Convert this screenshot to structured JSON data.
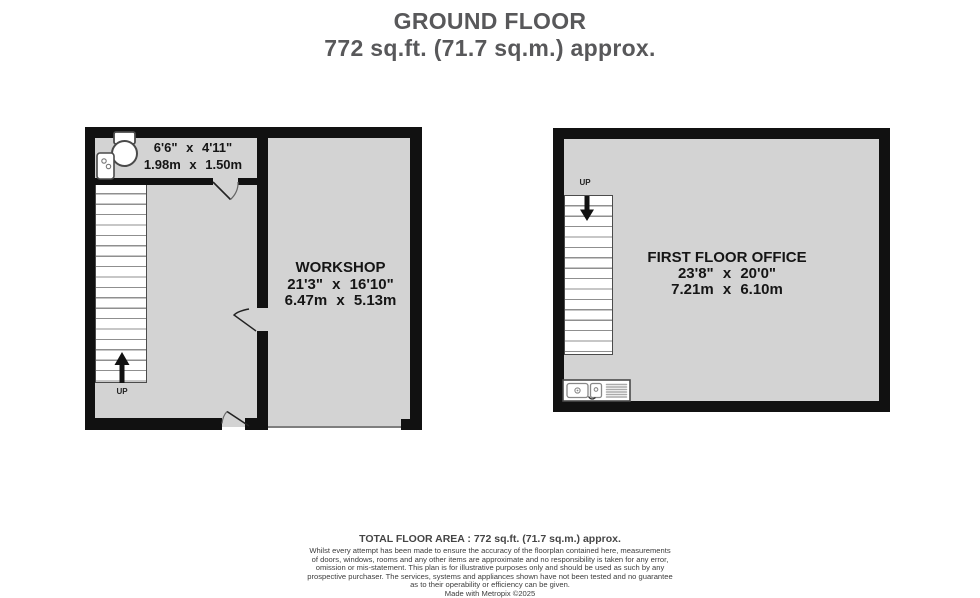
{
  "title": {
    "floor": "GROUND FLOOR",
    "area": "772 sq.ft. (71.7 sq.m.) approx."
  },
  "ground_floor_plan": {
    "wc": {
      "dims_imperial": "6'6\" x 4'11\"",
      "dims_metric": "1.98m x 1.50m"
    },
    "workshop": {
      "name": "WORKSHOP",
      "dims_imperial": "21'3\" x 16'10\"",
      "dims_metric": "6.47m x 5.13m"
    },
    "stairs_direction": "UP"
  },
  "first_floor_plan": {
    "office": {
      "name": "FIRST FLOOR OFFICE",
      "dims_imperial": "23'8\" x 20'0\"",
      "dims_metric": "7.21m x 6.10m"
    },
    "stairs_direction": "UP"
  },
  "footer": {
    "total_area": "TOTAL FLOOR AREA : 772 sq.ft. (71.7 sq.m.) approx.",
    "disclaimer_lines": [
      "Whilst every attempt has been made to ensure the accuracy of the floorplan contained here, measurements",
      "of doors, windows, rooms and any other items are approximate and no responsibility is taken for any error,",
      "omission or mis-statement. This plan is for illustrative purposes only and should be used as such by any",
      "prospective purchaser. The services, systems and appliances shown have not been tested and no guarantee",
      "as to their operability or efficiency can be given."
    ],
    "credit": "Made with Metropix ©2025"
  },
  "icons": {
    "toilet": "toilet-icon",
    "basin": "basin-icon",
    "sink_drainer": "sink-drainer-icon",
    "stairs_up_arrow": "up-arrow-icon",
    "stairs_down_arrow": "down-arrow-icon"
  },
  "colors": {
    "wall": "#111111",
    "floor_fill": "#d3d3d3",
    "title_text": "#58585a",
    "label_text": "#151515"
  }
}
